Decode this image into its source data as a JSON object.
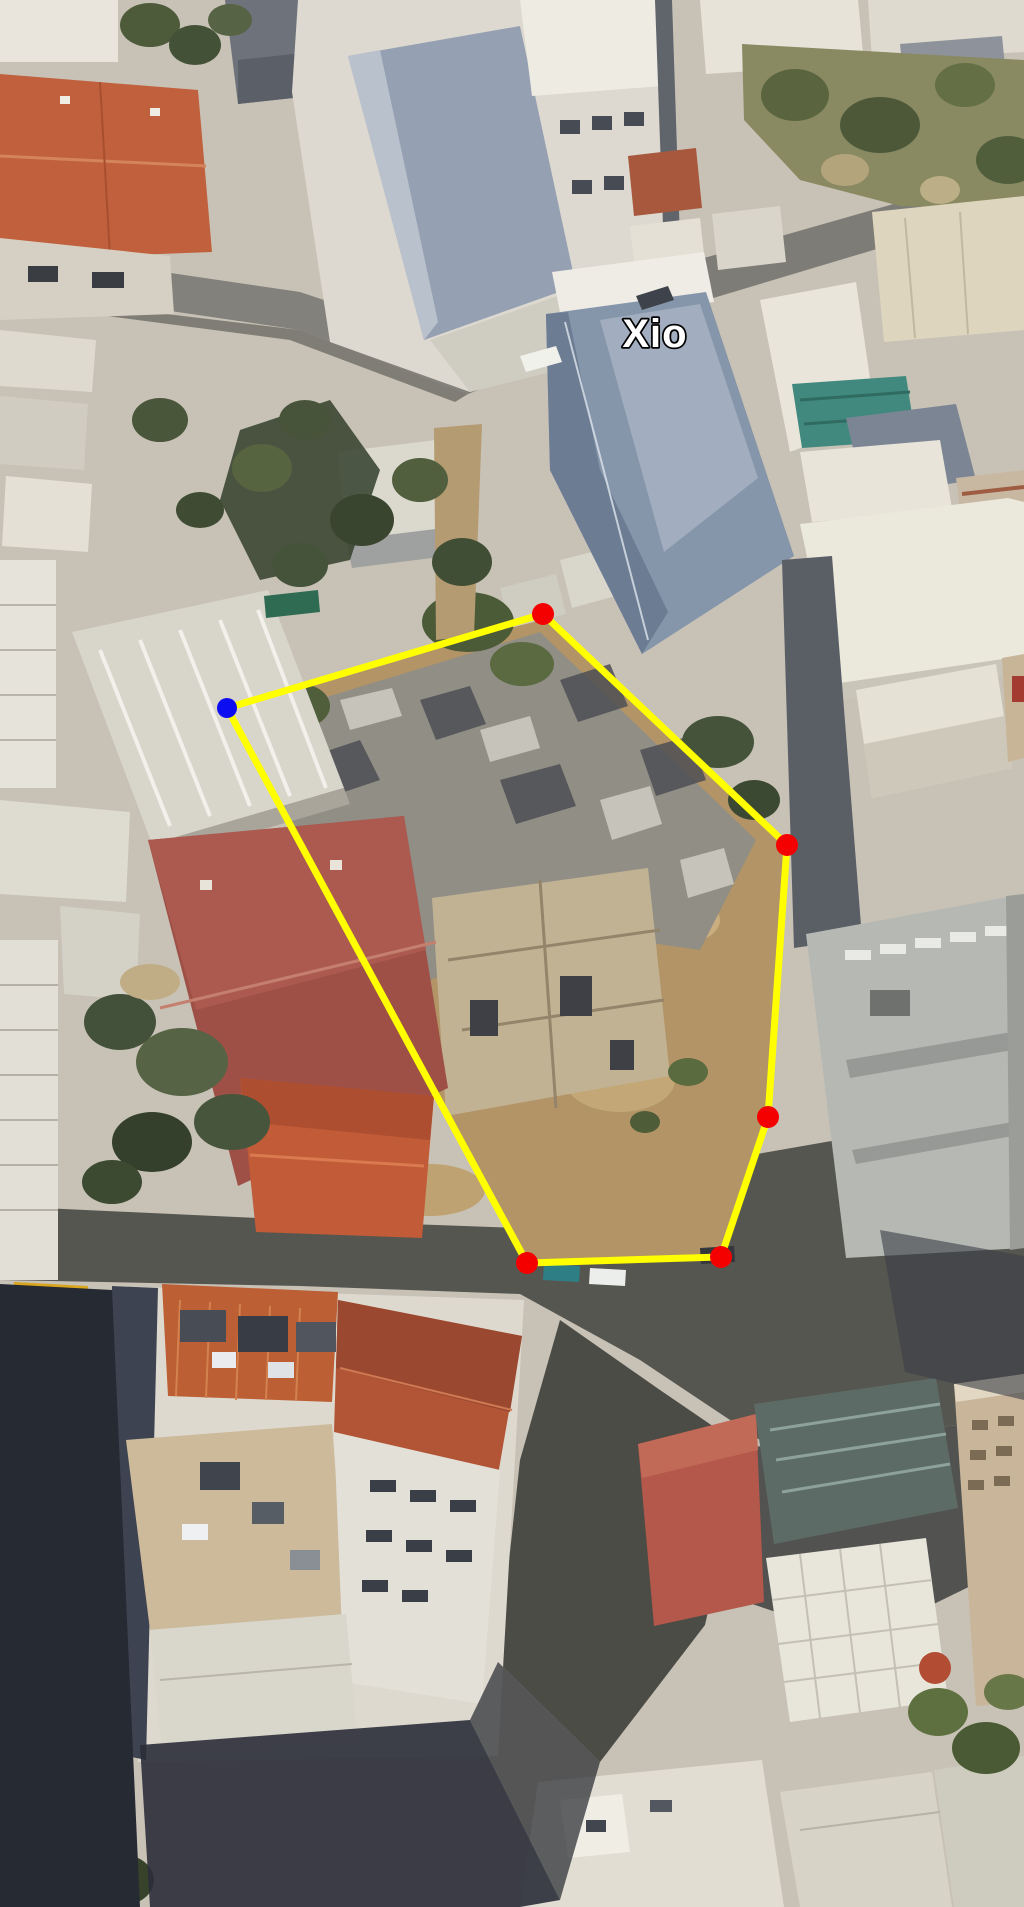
{
  "map": {
    "view": "satellite-3d-aerial",
    "scene_description": "Oblique aerial imagery of a dense Mediterranean town block: terracotta and white roofs, a slate-roofed building labeled Xio, a rubble/dirt vacant parcel outlined by a yellow measuring polygon, streets with deep building shadows, scattered trees.",
    "palette": {
      "ground": "#c8c2b6",
      "street_light": "#82817b",
      "street_dark": "#55554f",
      "roof_terracotta": "#c0603c",
      "roof_maroon": "#9e5046",
      "roof_slate": "#8595aa",
      "roof_white": "#e8e4d9",
      "parcel_dirt": "#b29467",
      "ruins_grey": "#908e85",
      "vegetation": "#49563a",
      "shadow": "#262a33"
    },
    "place_label": {
      "text": "Xio",
      "x": 655,
      "y": 347,
      "font_size": 40,
      "fill": "#ffffff",
      "outline": "#000000"
    },
    "overlay": {
      "line_color": "#ffff00",
      "line_width": 7,
      "closed": true,
      "vertices": [
        {
          "x": 227,
          "y": 708,
          "r": 10,
          "type": "blue",
          "color": "#0d0df2"
        },
        {
          "x": 543,
          "y": 614,
          "r": 11,
          "type": "red",
          "color": "#f50000"
        },
        {
          "x": 787,
          "y": 845,
          "r": 11,
          "type": "red",
          "color": "#f50000"
        },
        {
          "x": 768,
          "y": 1117,
          "r": 11,
          "type": "red",
          "color": "#f50000"
        },
        {
          "x": 721,
          "y": 1257,
          "r": 11,
          "type": "red",
          "color": "#f50000"
        },
        {
          "x": 527,
          "y": 1263,
          "r": 11,
          "type": "red",
          "color": "#f50000"
        }
      ]
    }
  }
}
